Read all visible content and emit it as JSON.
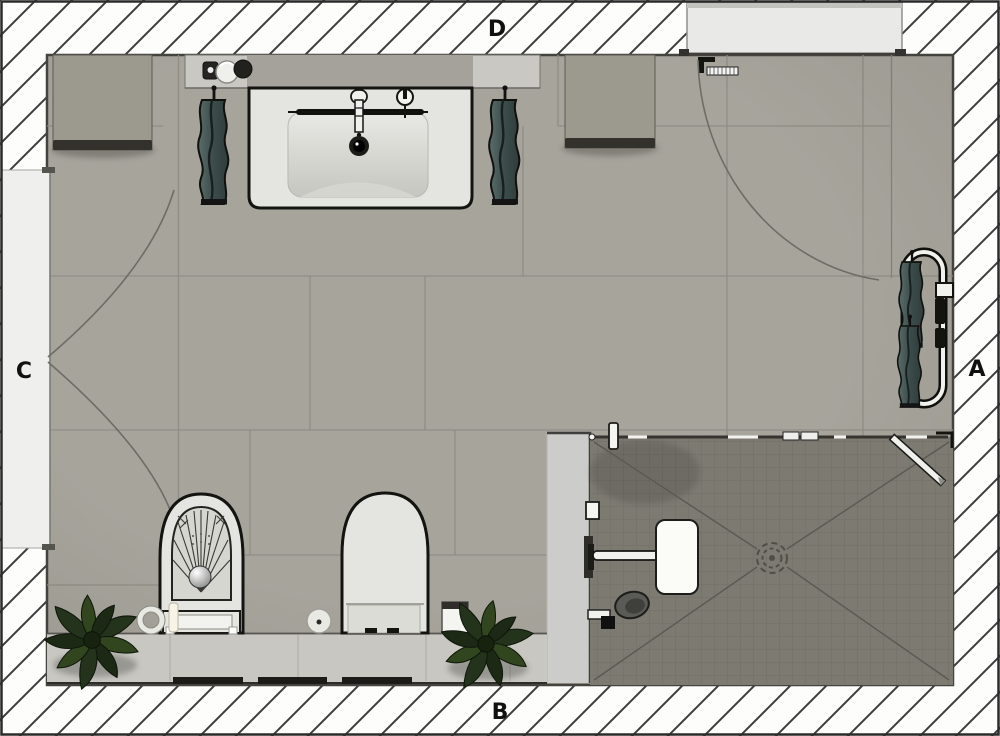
{
  "plan": {
    "wall_labels": {
      "top": "D",
      "bottom": "B",
      "left": "C",
      "right": "A"
    }
  },
  "colors": {
    "wall_fill": "#fdfdfc",
    "wall_hatch": "#3c3c3c",
    "floor_main": "#a7a49c",
    "floor_grout": "#908d85",
    "shower_floor": "#7d7a72",
    "shower_grout": "#6e6b63",
    "partition": "#cccccb",
    "ledge": "#c8c7c1",
    "cabinet": "#9c998f",
    "counter": "#c9c8c2",
    "vanity_top": "#a5a29b",
    "fixture_fill": "#e4e4e0",
    "fixture_outline": "#131310",
    "door_panel": "#e9e9e7",
    "towel_teal": "#47585a",
    "plant_green": "#2a3a20",
    "label_text": "#111111"
  }
}
